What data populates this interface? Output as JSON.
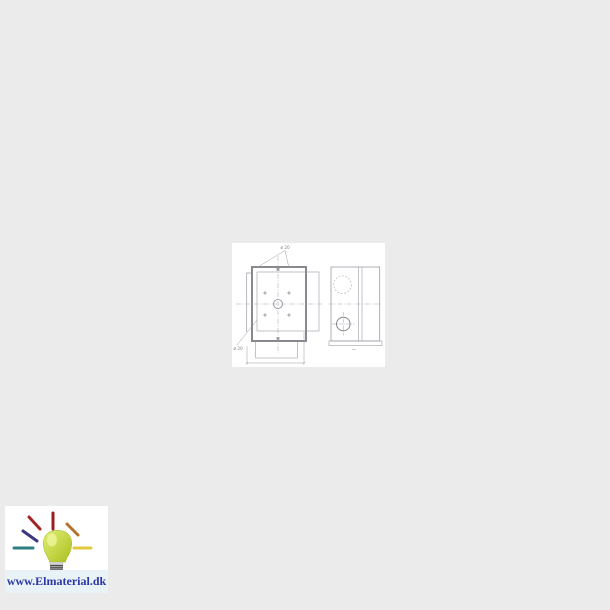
{
  "page": {
    "background_color": "#ebebeb"
  },
  "product_drawing": {
    "kind": "technical line drawing - mounting box, front view and side view",
    "panel_color": "#ffffff",
    "line_color": "#9b9ba6",
    "frame_line_color": "#88888e",
    "labels": {
      "top_knockouts_diameter": "ø 20",
      "side_knockout_diameter": "ø 20"
    }
  },
  "brand_watermark": {
    "url_text": "www.Elmaterial.dk",
    "text_color": "#2c37a6",
    "panel_color": "#ffffff",
    "band_color": "#e9f3f7",
    "bulb": {
      "glass_top_color": "#e2ef75",
      "glass_bottom_color": "#aabf1f",
      "base_color": "#b7b7b7",
      "thread_line_color": "#4e4e4e"
    },
    "rays": [
      {
        "name": "top",
        "color": "#9e1b20"
      },
      {
        "name": "upper-left",
        "color": "#a42422"
      },
      {
        "name": "left-diagonal",
        "color": "#3c3880"
      },
      {
        "name": "left",
        "color": "#2e7f86"
      },
      {
        "name": "upper-right",
        "color": "#b5722e"
      },
      {
        "name": "right",
        "color": "#e3c93f"
      }
    ]
  }
}
